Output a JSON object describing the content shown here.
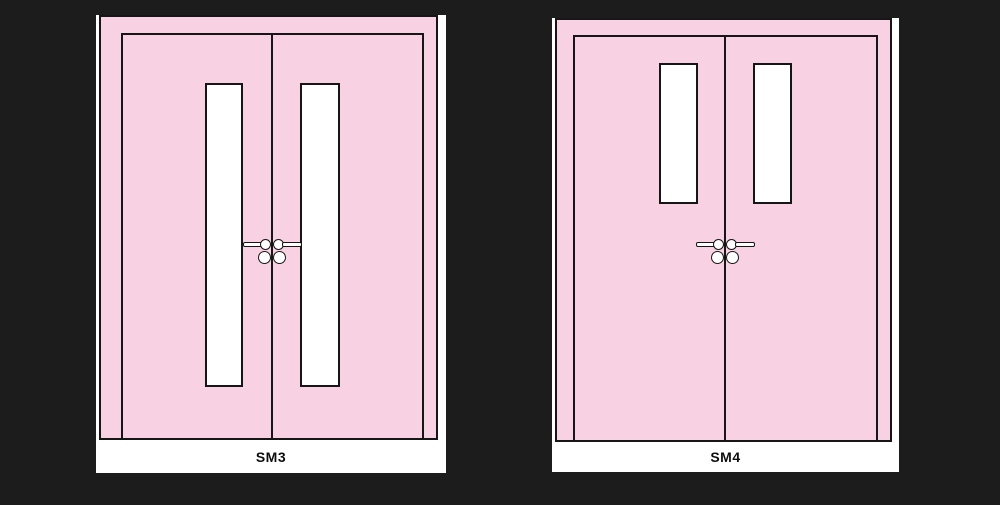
{
  "colors": {
    "background": "#1c1c1c",
    "door_pink": "#f8d2e2",
    "outline": "#161616",
    "panel_white": "#ffffff"
  },
  "figures": [
    {
      "label": "SM3"
    },
    {
      "label": "SM4"
    }
  ]
}
